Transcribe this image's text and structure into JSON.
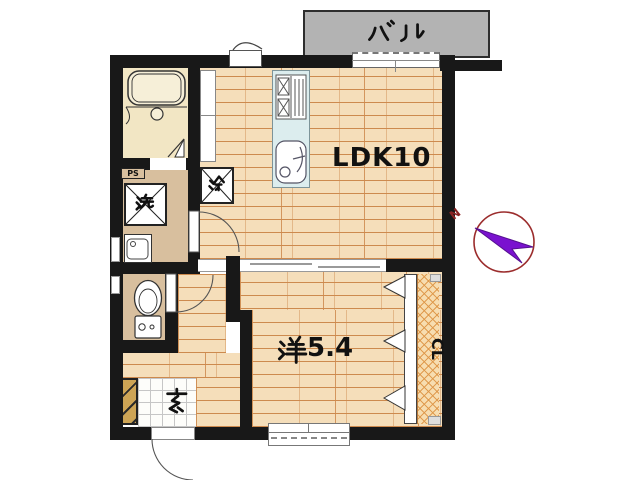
{
  "plan": {
    "labels": {
      "balcony": "バル",
      "ldk": "LDK10",
      "western_room": "洋5.4",
      "western_room_number": "5.4",
      "entrance": "玄",
      "closet": "CL",
      "refrigerator": "冷",
      "washer": "洗",
      "pipe_space": "PS",
      "compass_north": "N"
    },
    "colors": {
      "wall": "#181818",
      "wood_floor": "#f5deba",
      "plank_line": "#cd8a4e",
      "hall_tan": "#d8bf9e",
      "bathroom_cream": "#f2e6c4",
      "balcony_gray": "#b3b3b3",
      "kitchen_counter": "#dcedee",
      "closet_hatch": "#f7ddb0",
      "shoebox": "#cda455",
      "compass_ring": "#9b2c2c",
      "compass_needle": "#7a12cf",
      "genkan_tile": "#fdfdfa"
    }
  }
}
